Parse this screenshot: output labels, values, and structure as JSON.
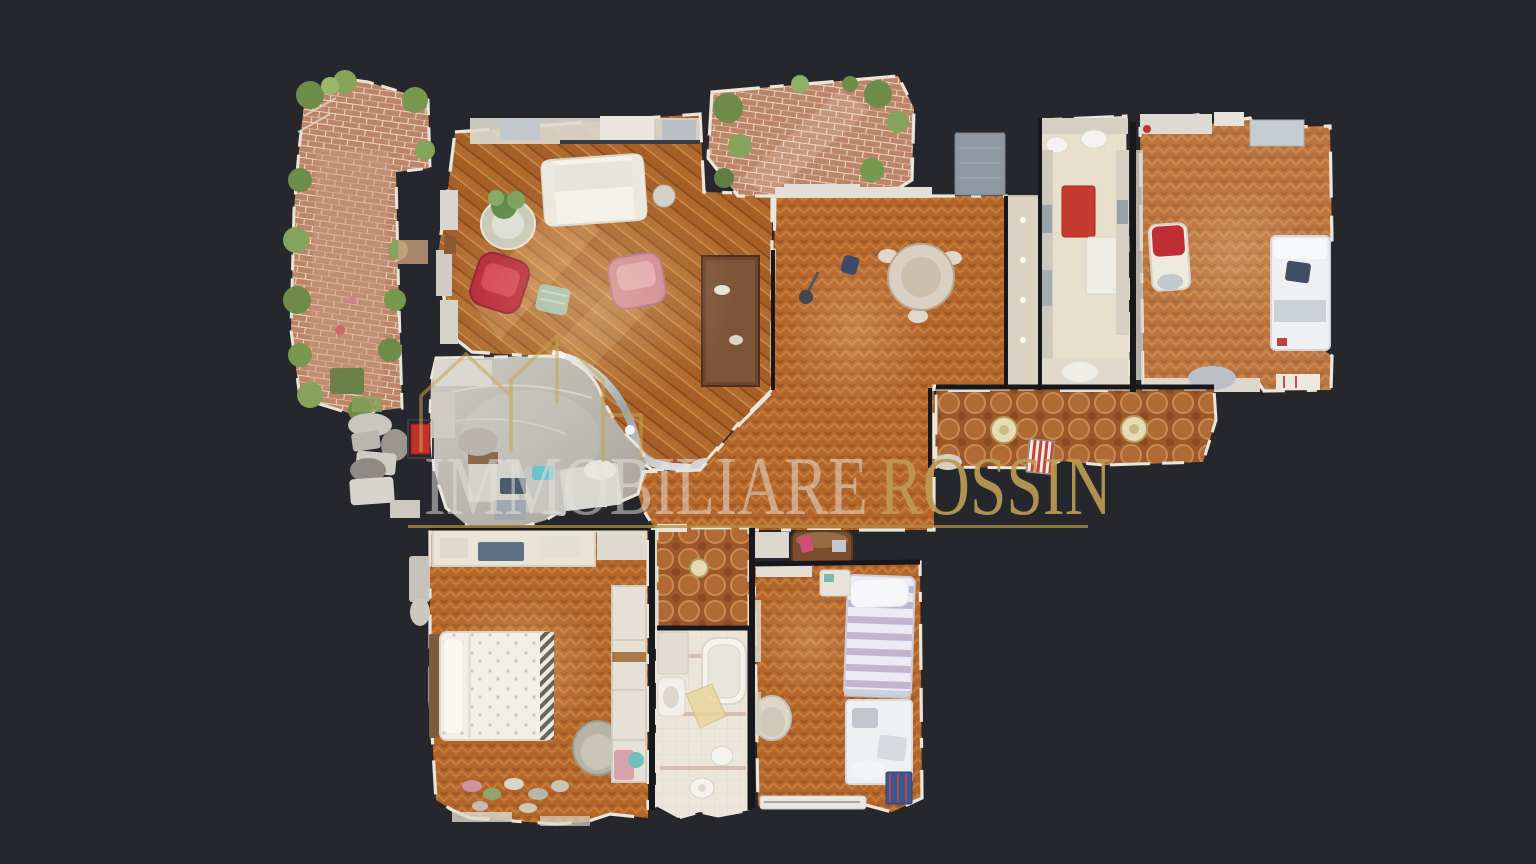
{
  "watermark": {
    "brand_part1": "IMMOBILIARE",
    "brand_part2": "ROSSIN"
  },
  "colors": {
    "background": "#26272c",
    "brand_gold": "#bd9a52",
    "brand_text_light": "#e4e2dc",
    "underline_gold": "#b08f46"
  }
}
